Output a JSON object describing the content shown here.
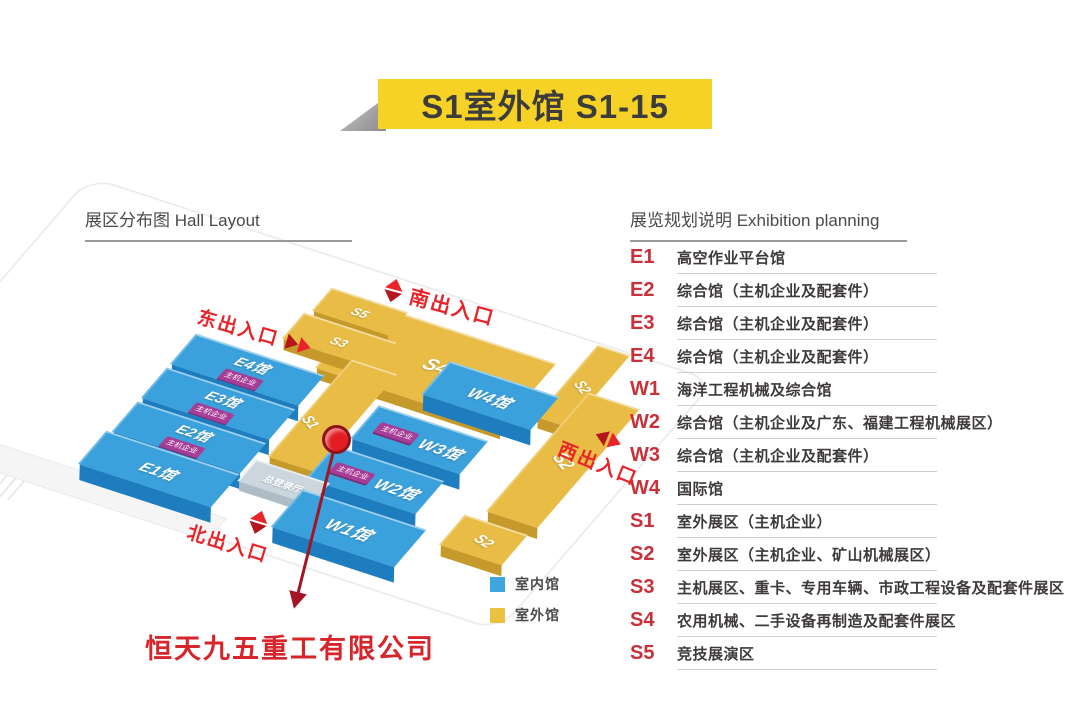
{
  "banner": {
    "title": "S1室外馆 S1-15"
  },
  "sections": {
    "hall_layout": "展区分布图 Hall Layout",
    "exhibition_planning": "展览规划说明 Exhibition planning"
  },
  "planning": [
    {
      "code": "E1",
      "desc": "高空作业平台馆"
    },
    {
      "code": "E2",
      "desc": "综合馆（主机企业及配套件）"
    },
    {
      "code": "E3",
      "desc": "综合馆（主机企业及配套件）"
    },
    {
      "code": "E4",
      "desc": "综合馆（主机企业及配套件）"
    },
    {
      "code": "W1",
      "desc": "海洋工程机械及综合馆"
    },
    {
      "code": "W2",
      "desc": "综合馆（主机企业及广东、福建工程机械展区）"
    },
    {
      "code": "W3",
      "desc": "综合馆（主机企业及配套件）"
    },
    {
      "code": "W4",
      "desc": "国际馆"
    },
    {
      "code": "S1",
      "desc": "室外展区（主机企业）"
    },
    {
      "code": "S2",
      "desc": "室外展区（主机企业、矿山机械展区）"
    },
    {
      "code": "S3",
      "desc": "主机展区、重卡、专用车辆、市政工程设备及配套件展区"
    },
    {
      "code": "S4",
      "desc": "农用机械、二手设备再制造及配套件展区"
    },
    {
      "code": "S5",
      "desc": "竞技展演区"
    }
  ],
  "map": {
    "entrances": {
      "south": "南出入口",
      "east": "东出入口",
      "west": "西出入口",
      "north": "北出入口"
    },
    "halls": {
      "e1": "E1馆",
      "e2": "E2馆",
      "e3": "E3馆",
      "e4": "E4馆",
      "w1": "W1馆",
      "w2": "W2馆",
      "w3": "W3馆",
      "w4": "W4馆",
      "s1": "S1",
      "s2": "S2",
      "s3": "S3",
      "s4": "S4",
      "s5": "S5",
      "registration_hall": "总登录厅",
      "badge": "主机企业"
    },
    "legend": [
      {
        "label": "室内馆",
        "color": "#3FA5DF"
      },
      {
        "label": "室外馆",
        "color": "#EAC23F"
      }
    ],
    "callout": "恒天九五重工有限公司"
  },
  "colors": {
    "indoor": "#3FA5DF",
    "outdoor": "#EAC23F",
    "accent_red": "#E8232A",
    "banner_yellow": "#F7D226"
  }
}
